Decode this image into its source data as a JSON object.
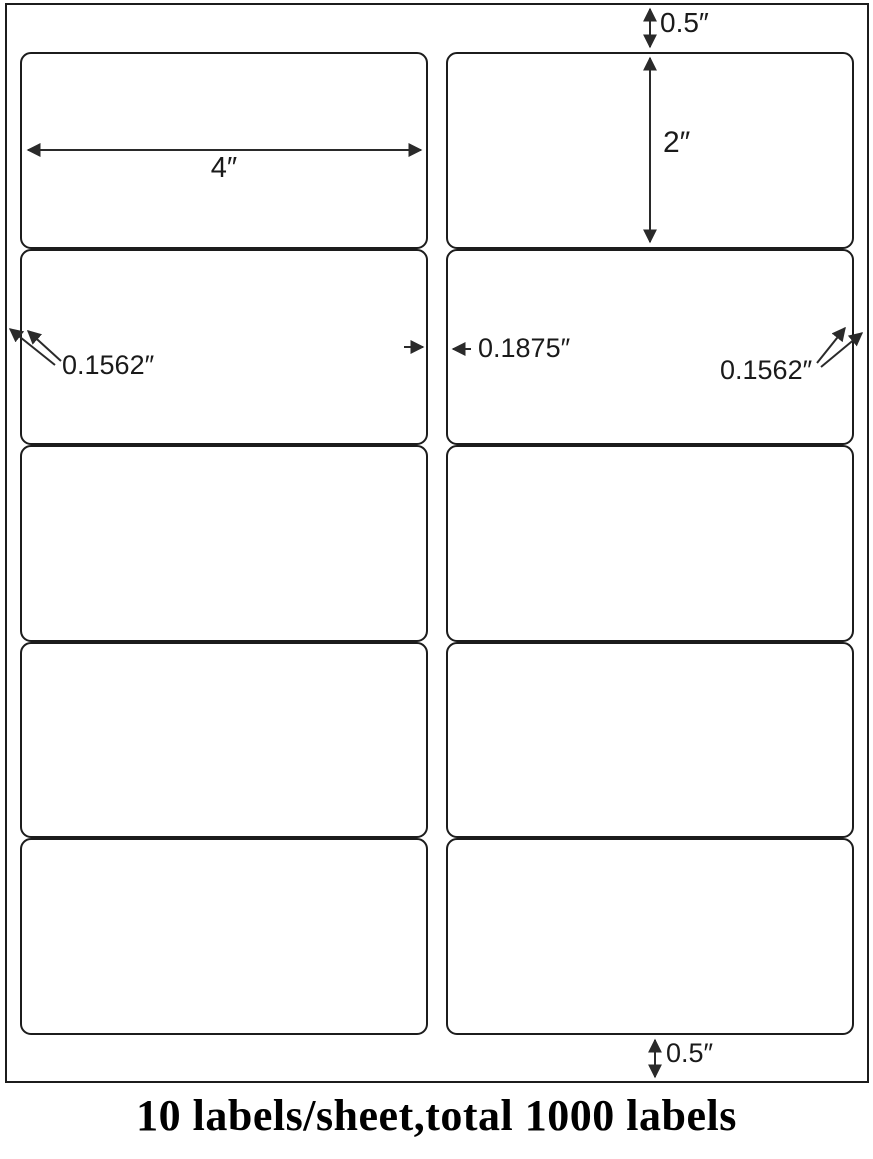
{
  "diagram": {
    "caption": "10 labels/sheet,total 1000 labels",
    "sheet": {
      "rows": 5,
      "columns": 2,
      "labels_visible": 10
    },
    "dimensions": {
      "top_margin": "0.5″",
      "label_height": "2″",
      "label_width": "4″",
      "left_margin": "0.1562″",
      "column_gap": "0.1875″",
      "right_margin": "0.1562″",
      "bottom_margin": "0.5″"
    },
    "colors": {
      "line": "#1c1c1c",
      "background": "#ffffff",
      "text": "#1a1a1a"
    }
  }
}
